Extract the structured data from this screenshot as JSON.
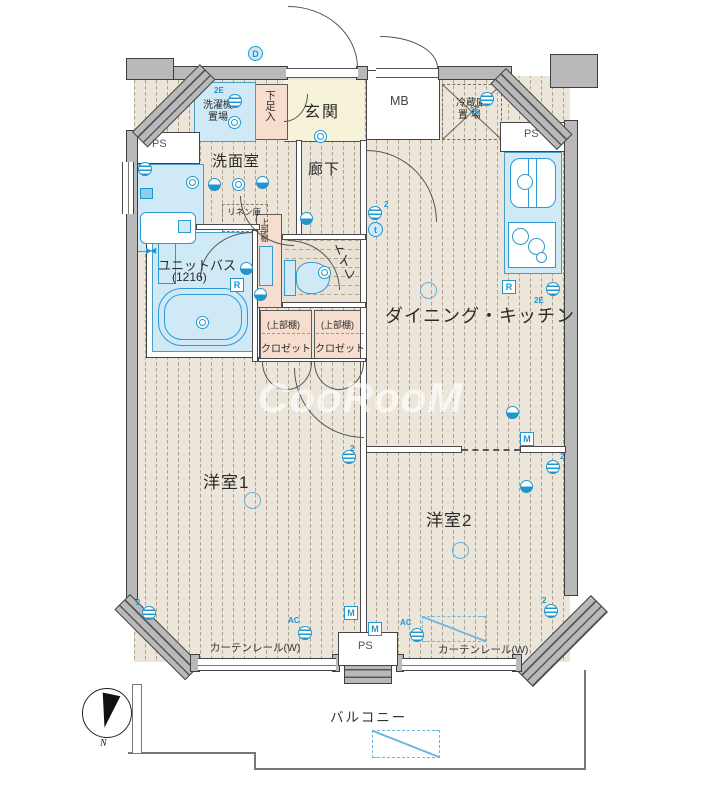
{
  "watermark": "CooRooM",
  "compass": {
    "north": "N"
  },
  "labels": {
    "entrance": "玄関",
    "shoe_box": "下足入",
    "meter_box": "MB",
    "laundry_1": "洗濯機",
    "laundry_2": "置場",
    "fridge_1": "冷蔵庫",
    "fridge_2": "置 場",
    "pipe_space": "PS",
    "washroom": "洗面室",
    "linen": "リネン庫",
    "corridor": "廊下",
    "unit_bath": "ユニットバス",
    "bath_size": "(1216)",
    "upper_shelf": "上部棚",
    "toilet": "トイレ",
    "closet_upper": "(上部棚)",
    "closet": "クロゼット",
    "dining_kitchen": "ダイニング・キッチン",
    "room1": "洋室1",
    "room2": "洋室2",
    "curtain_rail": "カーテンレール(W)",
    "balcony": "バルコニー"
  },
  "colors": {
    "accent_blue": "#2196cd",
    "water_blue": "#cfe9f7",
    "floor_beige": "#ece5d9",
    "pink": "#f7ddcd",
    "entrance_yellow": "#f7f3d8",
    "wall_gray": "#b9b9b9"
  },
  "markers": [
    {
      "t": "circled",
      "x": 248,
      "y": 46,
      "label": "D"
    },
    {
      "t": "txt",
      "x": 214,
      "y": 86,
      "label": "2E"
    },
    {
      "t": "outlet",
      "x": 228,
      "y": 94
    },
    {
      "t": "ring2",
      "x": 228,
      "y": 116
    },
    {
      "t": "outlet",
      "x": 138,
      "y": 162
    },
    {
      "t": "sq",
      "x": 140,
      "y": 188
    },
    {
      "t": "ring2",
      "x": 186,
      "y": 176
    },
    {
      "t": "pie",
      "x": 208,
      "y": 178
    },
    {
      "t": "ring2",
      "x": 232,
      "y": 178
    },
    {
      "t": "pie",
      "x": 256,
      "y": 176
    },
    {
      "t": "ring2",
      "x": 314,
      "y": 130
    },
    {
      "t": "pie",
      "x": 300,
      "y": 212
    },
    {
      "t": "txt",
      "x": 384,
      "y": 200,
      "label": "2"
    },
    {
      "t": "outlet",
      "x": 368,
      "y": 206
    },
    {
      "t": "circled",
      "x": 368,
      "y": 222,
      "label": "t"
    },
    {
      "t": "valve",
      "x": 146,
      "y": 246,
      "label": "▶◀"
    },
    {
      "t": "ring2",
      "x": 196,
      "y": 316
    },
    {
      "t": "pie",
      "x": 240,
      "y": 262
    },
    {
      "t": "boxl",
      "x": 230,
      "y": 278,
      "label": "R"
    },
    {
      "t": "pie",
      "x": 254,
      "y": 288
    },
    {
      "t": "ring2",
      "x": 318,
      "y": 266
    },
    {
      "t": "txt",
      "x": 470,
      "y": 106,
      "label": "2E"
    },
    {
      "t": "outlet",
      "x": 480,
      "y": 92
    },
    {
      "t": "boxl",
      "x": 502,
      "y": 280,
      "label": "R"
    },
    {
      "t": "outlet",
      "x": 546,
      "y": 282
    },
    {
      "t": "txt",
      "x": 534,
      "y": 296,
      "label": "2E"
    },
    {
      "t": "ring",
      "x": 420,
      "y": 282
    },
    {
      "t": "pie",
      "x": 506,
      "y": 406
    },
    {
      "t": "boxl",
      "x": 520,
      "y": 432,
      "label": "M"
    },
    {
      "t": "txt",
      "x": 560,
      "y": 452,
      "label": "2"
    },
    {
      "t": "outlet",
      "x": 546,
      "y": 460
    },
    {
      "t": "pie",
      "x": 520,
      "y": 480
    },
    {
      "t": "ring",
      "x": 452,
      "y": 542
    },
    {
      "t": "txt",
      "x": 542,
      "y": 596,
      "label": "2"
    },
    {
      "t": "outlet",
      "x": 544,
      "y": 604
    },
    {
      "t": "drect",
      "x": 422,
      "y": 616,
      "w": 64,
      "h": 26
    },
    {
      "t": "txt",
      "x": 400,
      "y": 618,
      "label": "AC"
    },
    {
      "t": "outlet",
      "x": 410,
      "y": 628
    },
    {
      "t": "boxl",
      "x": 368,
      "y": 622,
      "label": "M"
    },
    {
      "t": "ring",
      "x": 244,
      "y": 492
    },
    {
      "t": "txt",
      "x": 350,
      "y": 444,
      "label": "2"
    },
    {
      "t": "outlet",
      "x": 342,
      "y": 450
    },
    {
      "t": "txt",
      "x": 136,
      "y": 598,
      "label": "2"
    },
    {
      "t": "outlet",
      "x": 142,
      "y": 606
    },
    {
      "t": "txt",
      "x": 288,
      "y": 616,
      "label": "AC"
    },
    {
      "t": "outlet",
      "x": 298,
      "y": 626
    },
    {
      "t": "boxl",
      "x": 344,
      "y": 606,
      "label": "M"
    },
    {
      "t": "drect",
      "x": 372,
      "y": 730,
      "w": 68,
      "h": 28
    }
  ]
}
